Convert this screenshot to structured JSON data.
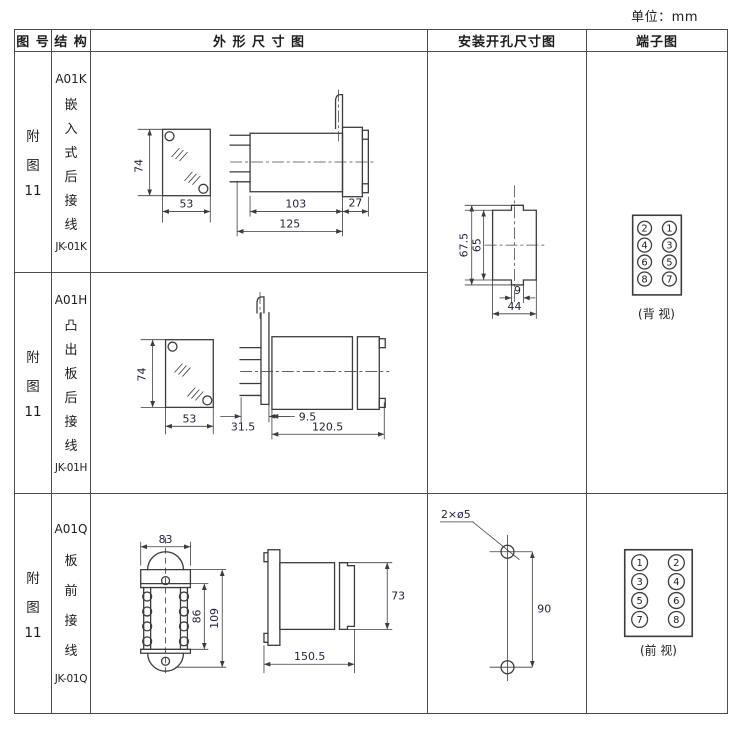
{
  "unit_label": "单位：mm",
  "header": {
    "fig": "图 号",
    "structure": "结 构",
    "outline": "外 形 尺 寸 图",
    "mounting": "安装开孔尺寸图",
    "terminal": "端子图"
  },
  "rows": [
    {
      "fig_lines": [
        "附",
        "图",
        "11"
      ],
      "model": "A01K",
      "structure_chars": [
        "嵌",
        "入",
        "式",
        "后",
        "接",
        "线"
      ],
      "code": "JK-01K",
      "dims": {
        "h": "74",
        "w": "53",
        "body": "103",
        "rear": "27",
        "total": "125"
      },
      "mount": {
        "outer_h": "67.5",
        "inner_h": "65",
        "notch_w": "9",
        "width": "44"
      },
      "terminal": {
        "cells": [
          "2",
          "1",
          "4",
          "3",
          "6",
          "5",
          "8",
          "7"
        ],
        "view_label": "(背 视)"
      }
    },
    {
      "fig_lines": [
        "附",
        "图",
        "11"
      ],
      "model": "A01H",
      "structure_chars": [
        "凸",
        "出",
        "板",
        "后",
        "接",
        "线"
      ],
      "code": "JK-01H",
      "dims": {
        "h": "74",
        "w": "53",
        "offset": "31.5",
        "panel": "9.5",
        "depth": "120.5"
      }
    },
    {
      "fig_lines": [
        "附",
        "图",
        "11"
      ],
      "model": "A01Q",
      "structure_chars": [
        "板",
        "前",
        "接",
        "线"
      ],
      "code": "JK-01Q",
      "dims": {
        "top_w": "83",
        "inner_h": "86",
        "outer_h": "109",
        "height": "73",
        "depth": "150.5"
      },
      "mount": {
        "holes": "2×ø5",
        "pitch": "90"
      },
      "terminal": {
        "cells": [
          "1",
          "2",
          "3",
          "4",
          "5",
          "6",
          "7",
          "8"
        ],
        "view_label": "(前 视)"
      }
    }
  ]
}
